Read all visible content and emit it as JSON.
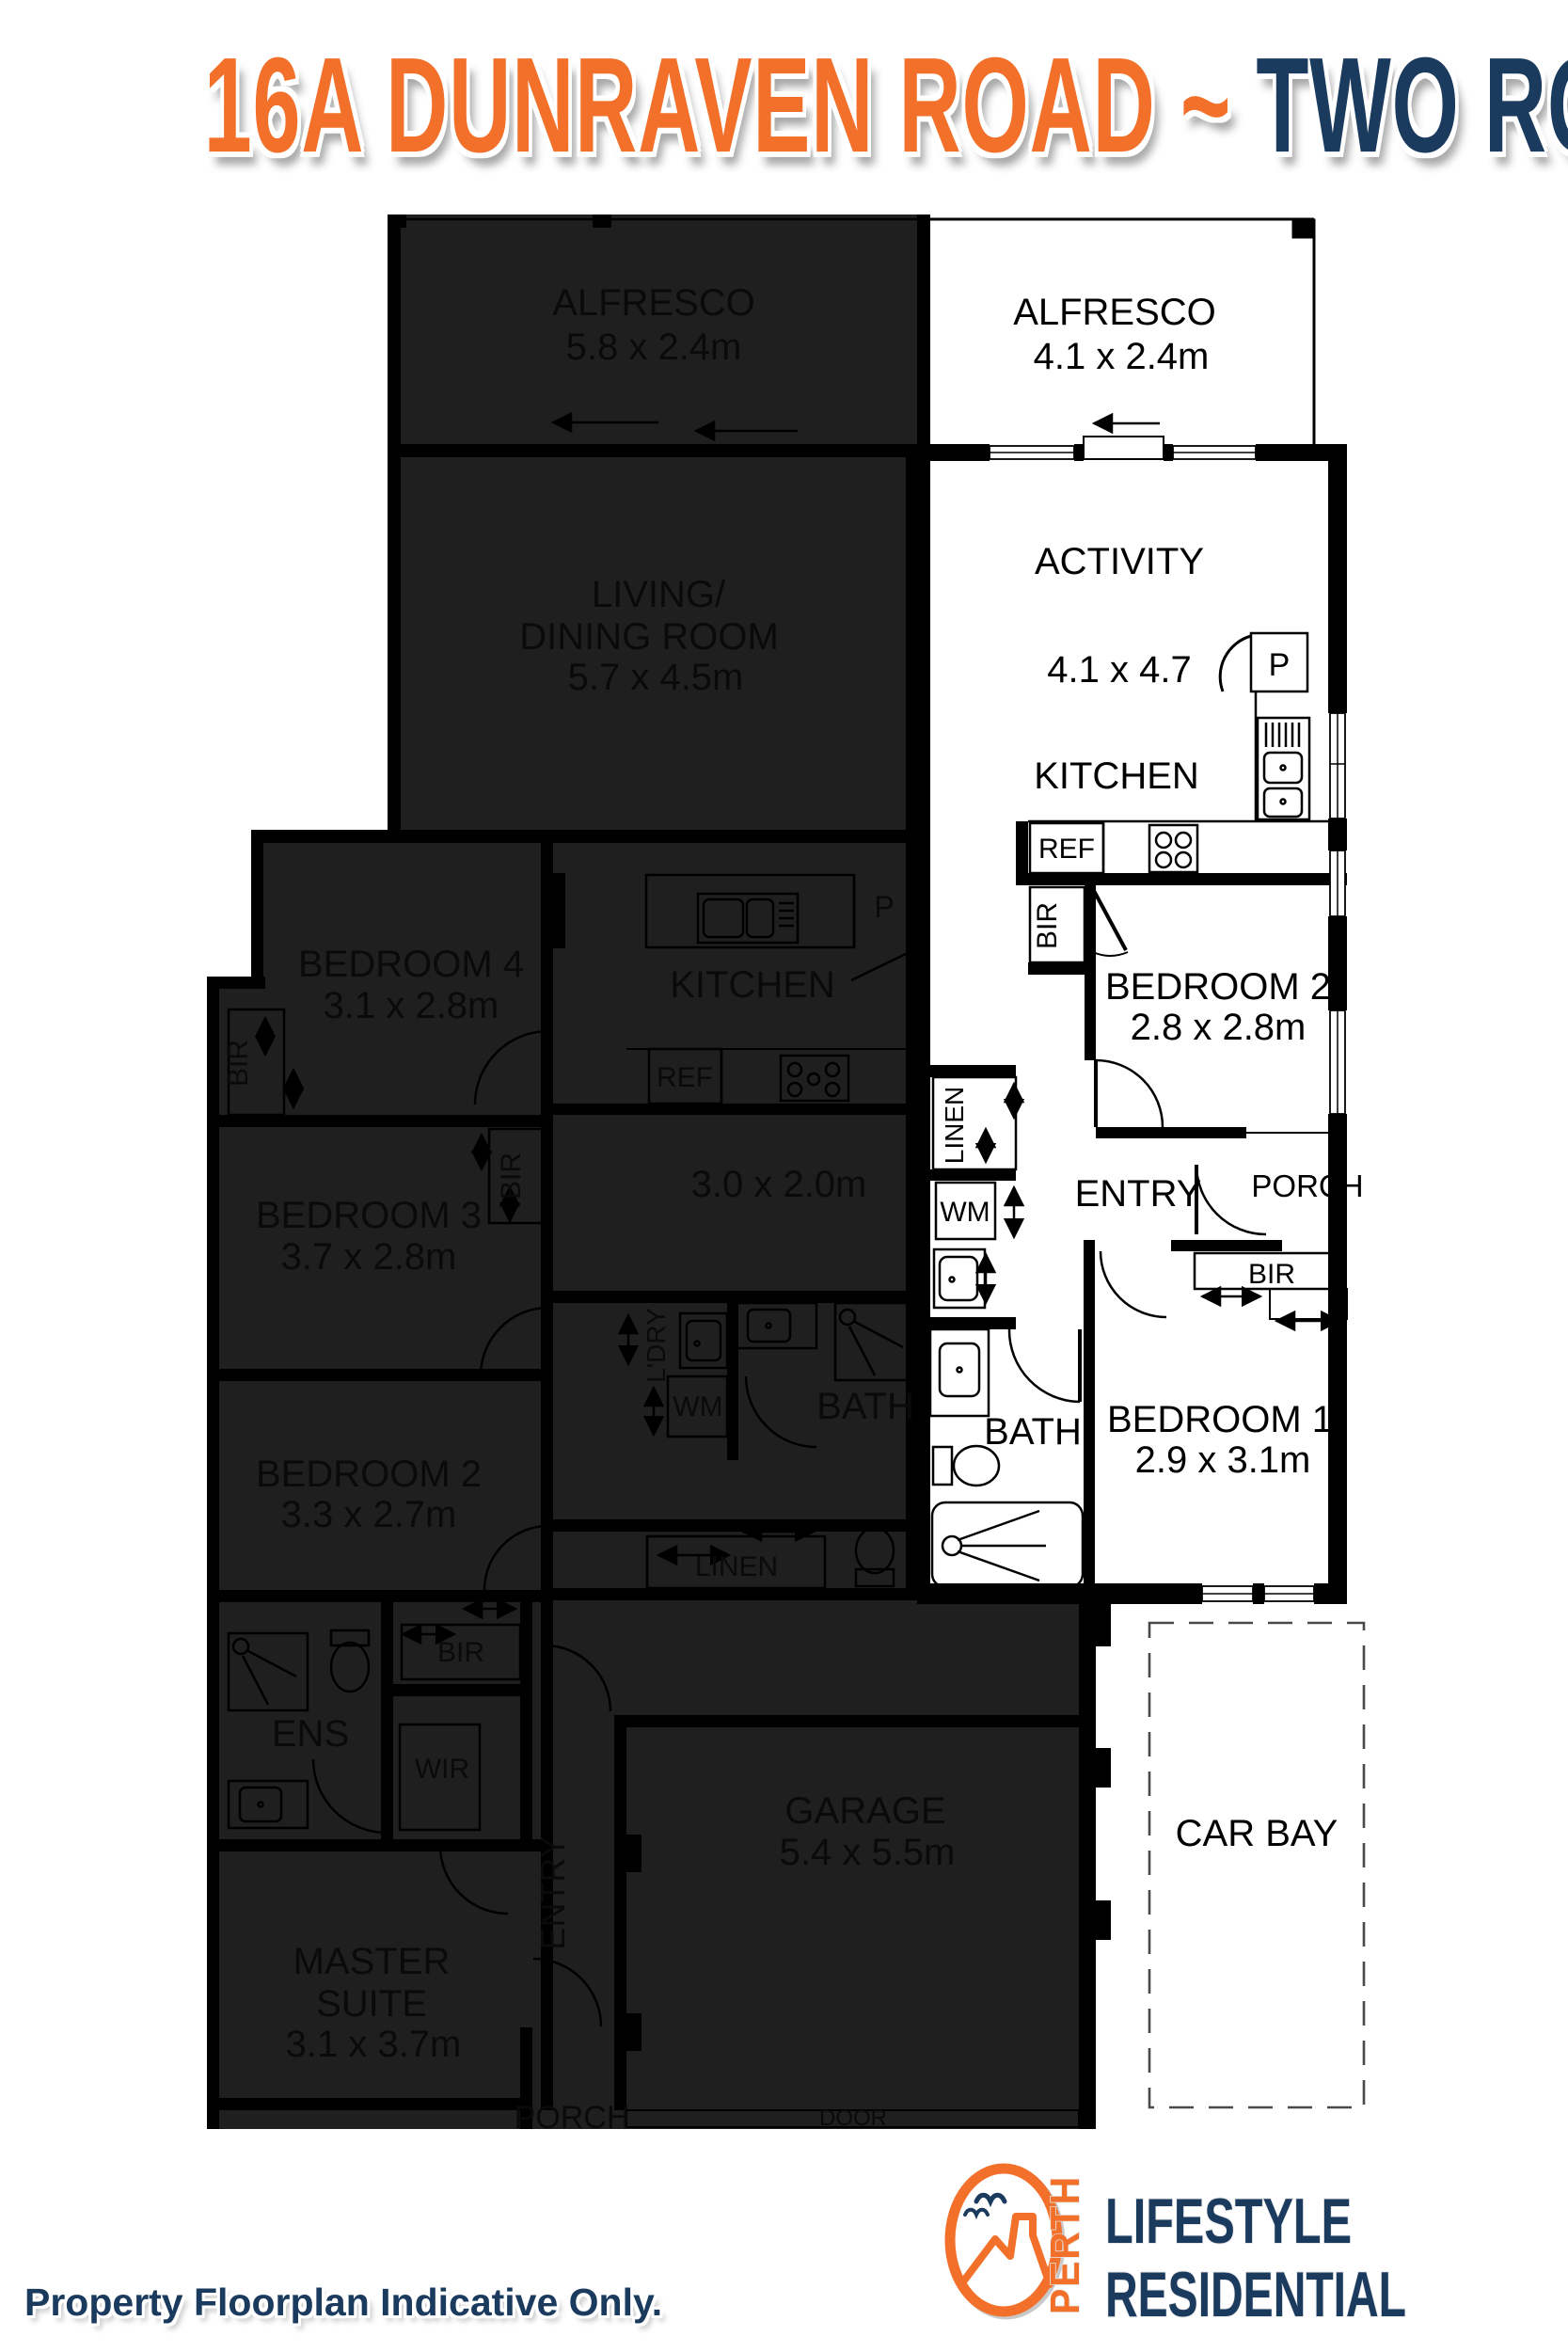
{
  "title": {
    "address": "16A DUNRAVEN ROAD",
    "tilde": "~",
    "suburb": "TWO ROCKS"
  },
  "disclaimer": "Property Floorplan Indicative Only.",
  "logo": {
    "perth": "PERTH",
    "lifestyle": "LIFESTYLE",
    "residential": "RESIDENTIAL"
  },
  "colors": {
    "orange": "#F2702A",
    "navy": "#1A3A5E",
    "overlay": "#1F1F1F",
    "wall": "#000000"
  },
  "unit_a": {
    "alfresco": {
      "name": "ALFRESCO",
      "dims": "4.1 x 2.4m"
    },
    "activity": {
      "name": "ACTIVITY",
      "dims": "4.1 x 4.7"
    },
    "kitchen": {
      "name": "KITCHEN",
      "pantry": "P",
      "fridge": "REF"
    },
    "bedroom2": {
      "name": "BEDROOM 2",
      "dims": "2.8 x 2.8m",
      "robe": "BIR"
    },
    "linen": "LINEN",
    "wm": "WM",
    "entry": "ENTRY",
    "porch": "PORCH",
    "bath": "BATH",
    "bedroom1": {
      "name": "BEDROOM 1",
      "dims": "2.9 x 3.1m",
      "robe": "BIR"
    },
    "car_bay": "CAR BAY"
  },
  "unit_b": {
    "alfresco": {
      "name": "ALFRESCO",
      "dims": "5.8 x 2.4m"
    },
    "living": {
      "line1": "LIVING/",
      "line2": "DINING ROOM",
      "dims": "5.7 x 4.5m"
    },
    "bedroom4": {
      "name": "BEDROOM 4",
      "dims": "3.1 x 2.8m",
      "robe": "BIR"
    },
    "kitchen": {
      "name": "KITCHEN",
      "pantry": "P",
      "fridge": "REF",
      "meals_dims": "3.0 x 2.0m"
    },
    "bedroom3": {
      "name": "BEDROOM 3",
      "dims": "3.7 x 2.8m",
      "robe": "BIR"
    },
    "bedroom2": {
      "name": "BEDROOM 2",
      "dims": "3.3 x 2.7m"
    },
    "laundry": {
      "name": "L'DRY",
      "wm": "WM"
    },
    "bath": "BATH",
    "linen": "LINEN",
    "ens": "ENS",
    "wir": "WIR",
    "master_robe": "BIR",
    "master": {
      "line1": "MASTER",
      "line2": "SUITE",
      "dims": "3.1 x 3.7m"
    },
    "entry": "ENTRY",
    "garage": {
      "name": "GARAGE",
      "dims": "5.4 x 5.5m",
      "door": "DOOR"
    },
    "porch": "PORCH"
  }
}
